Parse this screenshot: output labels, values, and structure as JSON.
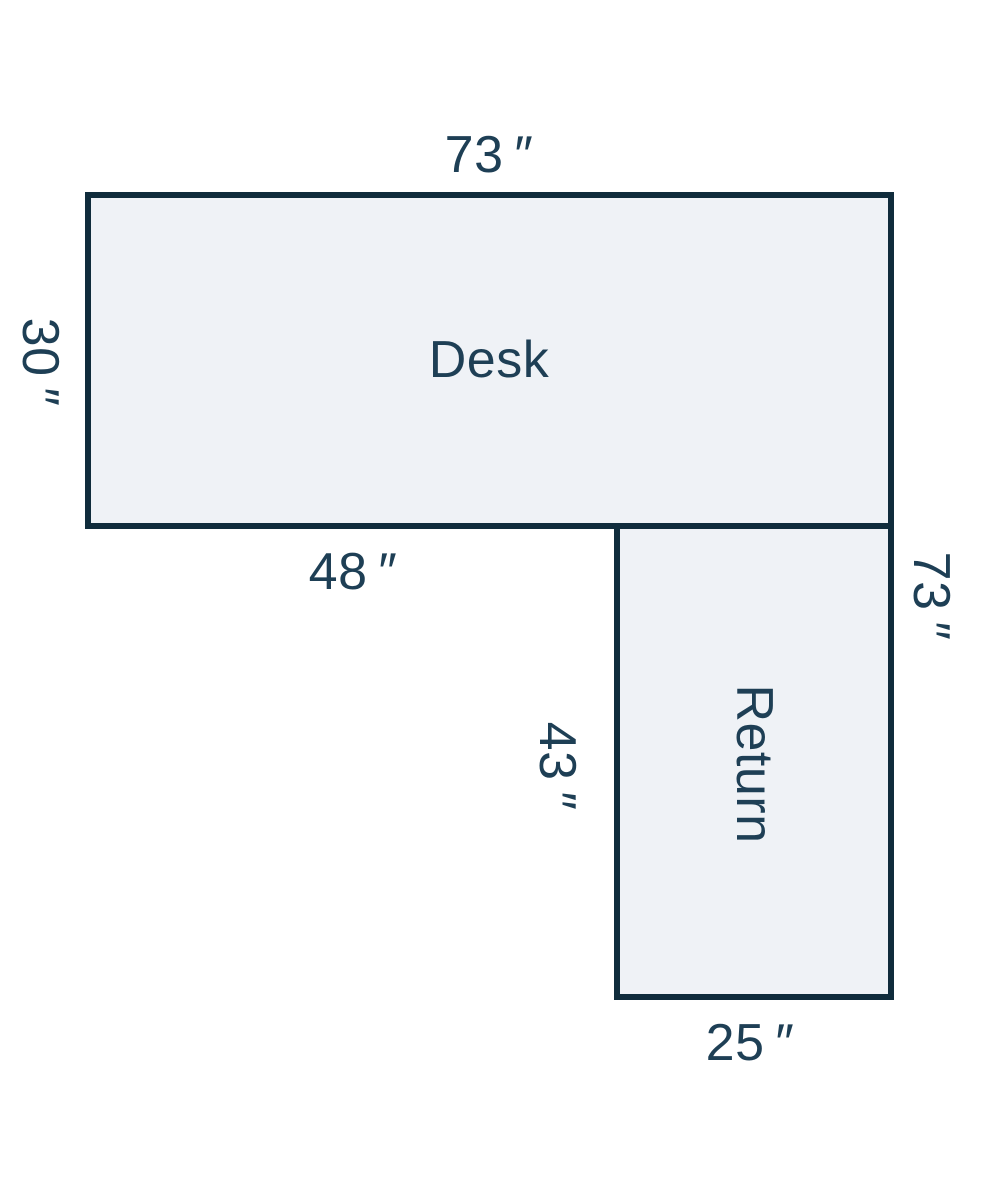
{
  "diagram": {
    "background_color": "#ffffff",
    "outline_color": "#102c3c",
    "fill_color": "#eff2f6",
    "text_color": "#1e3f55",
    "desk": {
      "label": "Desk",
      "top_width": "73 ″",
      "left_depth": "30 ″",
      "bottom_segment": "48 ″"
    },
    "return_unit": {
      "label": "Return",
      "right_height": "73 ″",
      "left_length": "43 ″",
      "bottom_width": "25 ″"
    }
  }
}
